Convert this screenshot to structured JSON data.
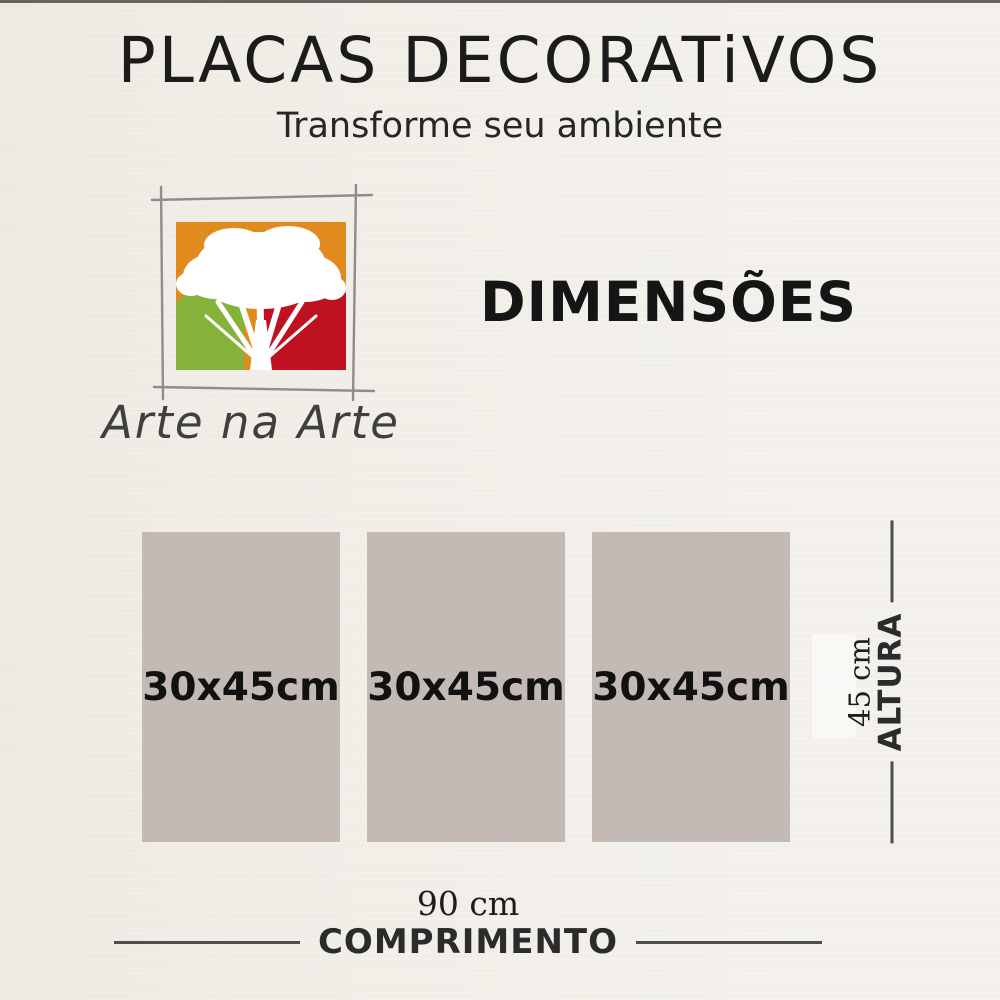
{
  "header": {
    "title": "PLACAS DECORATiVOS",
    "subtitle": "Transforme seu ambiente"
  },
  "logo": {
    "brand": "Arte na Arte",
    "icon": "tree-in-sketched-frame"
  },
  "section": {
    "heading": "DIMENSÕES"
  },
  "diagram": {
    "plaques": [
      {
        "label": "30x45cm"
      },
      {
        "label": "30x45cm"
      },
      {
        "label": "30x45cm"
      }
    ],
    "height_dimension": {
      "value": "45 cm",
      "label": "ALTURA"
    },
    "width_dimension": {
      "value": "90 cm",
      "label": "COMPRIMENTO"
    }
  },
  "colors": {
    "background": "#f2efe9",
    "plaque_fill": "#c4bab5",
    "logo_orange": "#e18a1e",
    "logo_green": "#85b23a",
    "logo_red": "#bf1120",
    "text_dark": "#1b1b1b",
    "line_gray": "#4e4e4e"
  }
}
